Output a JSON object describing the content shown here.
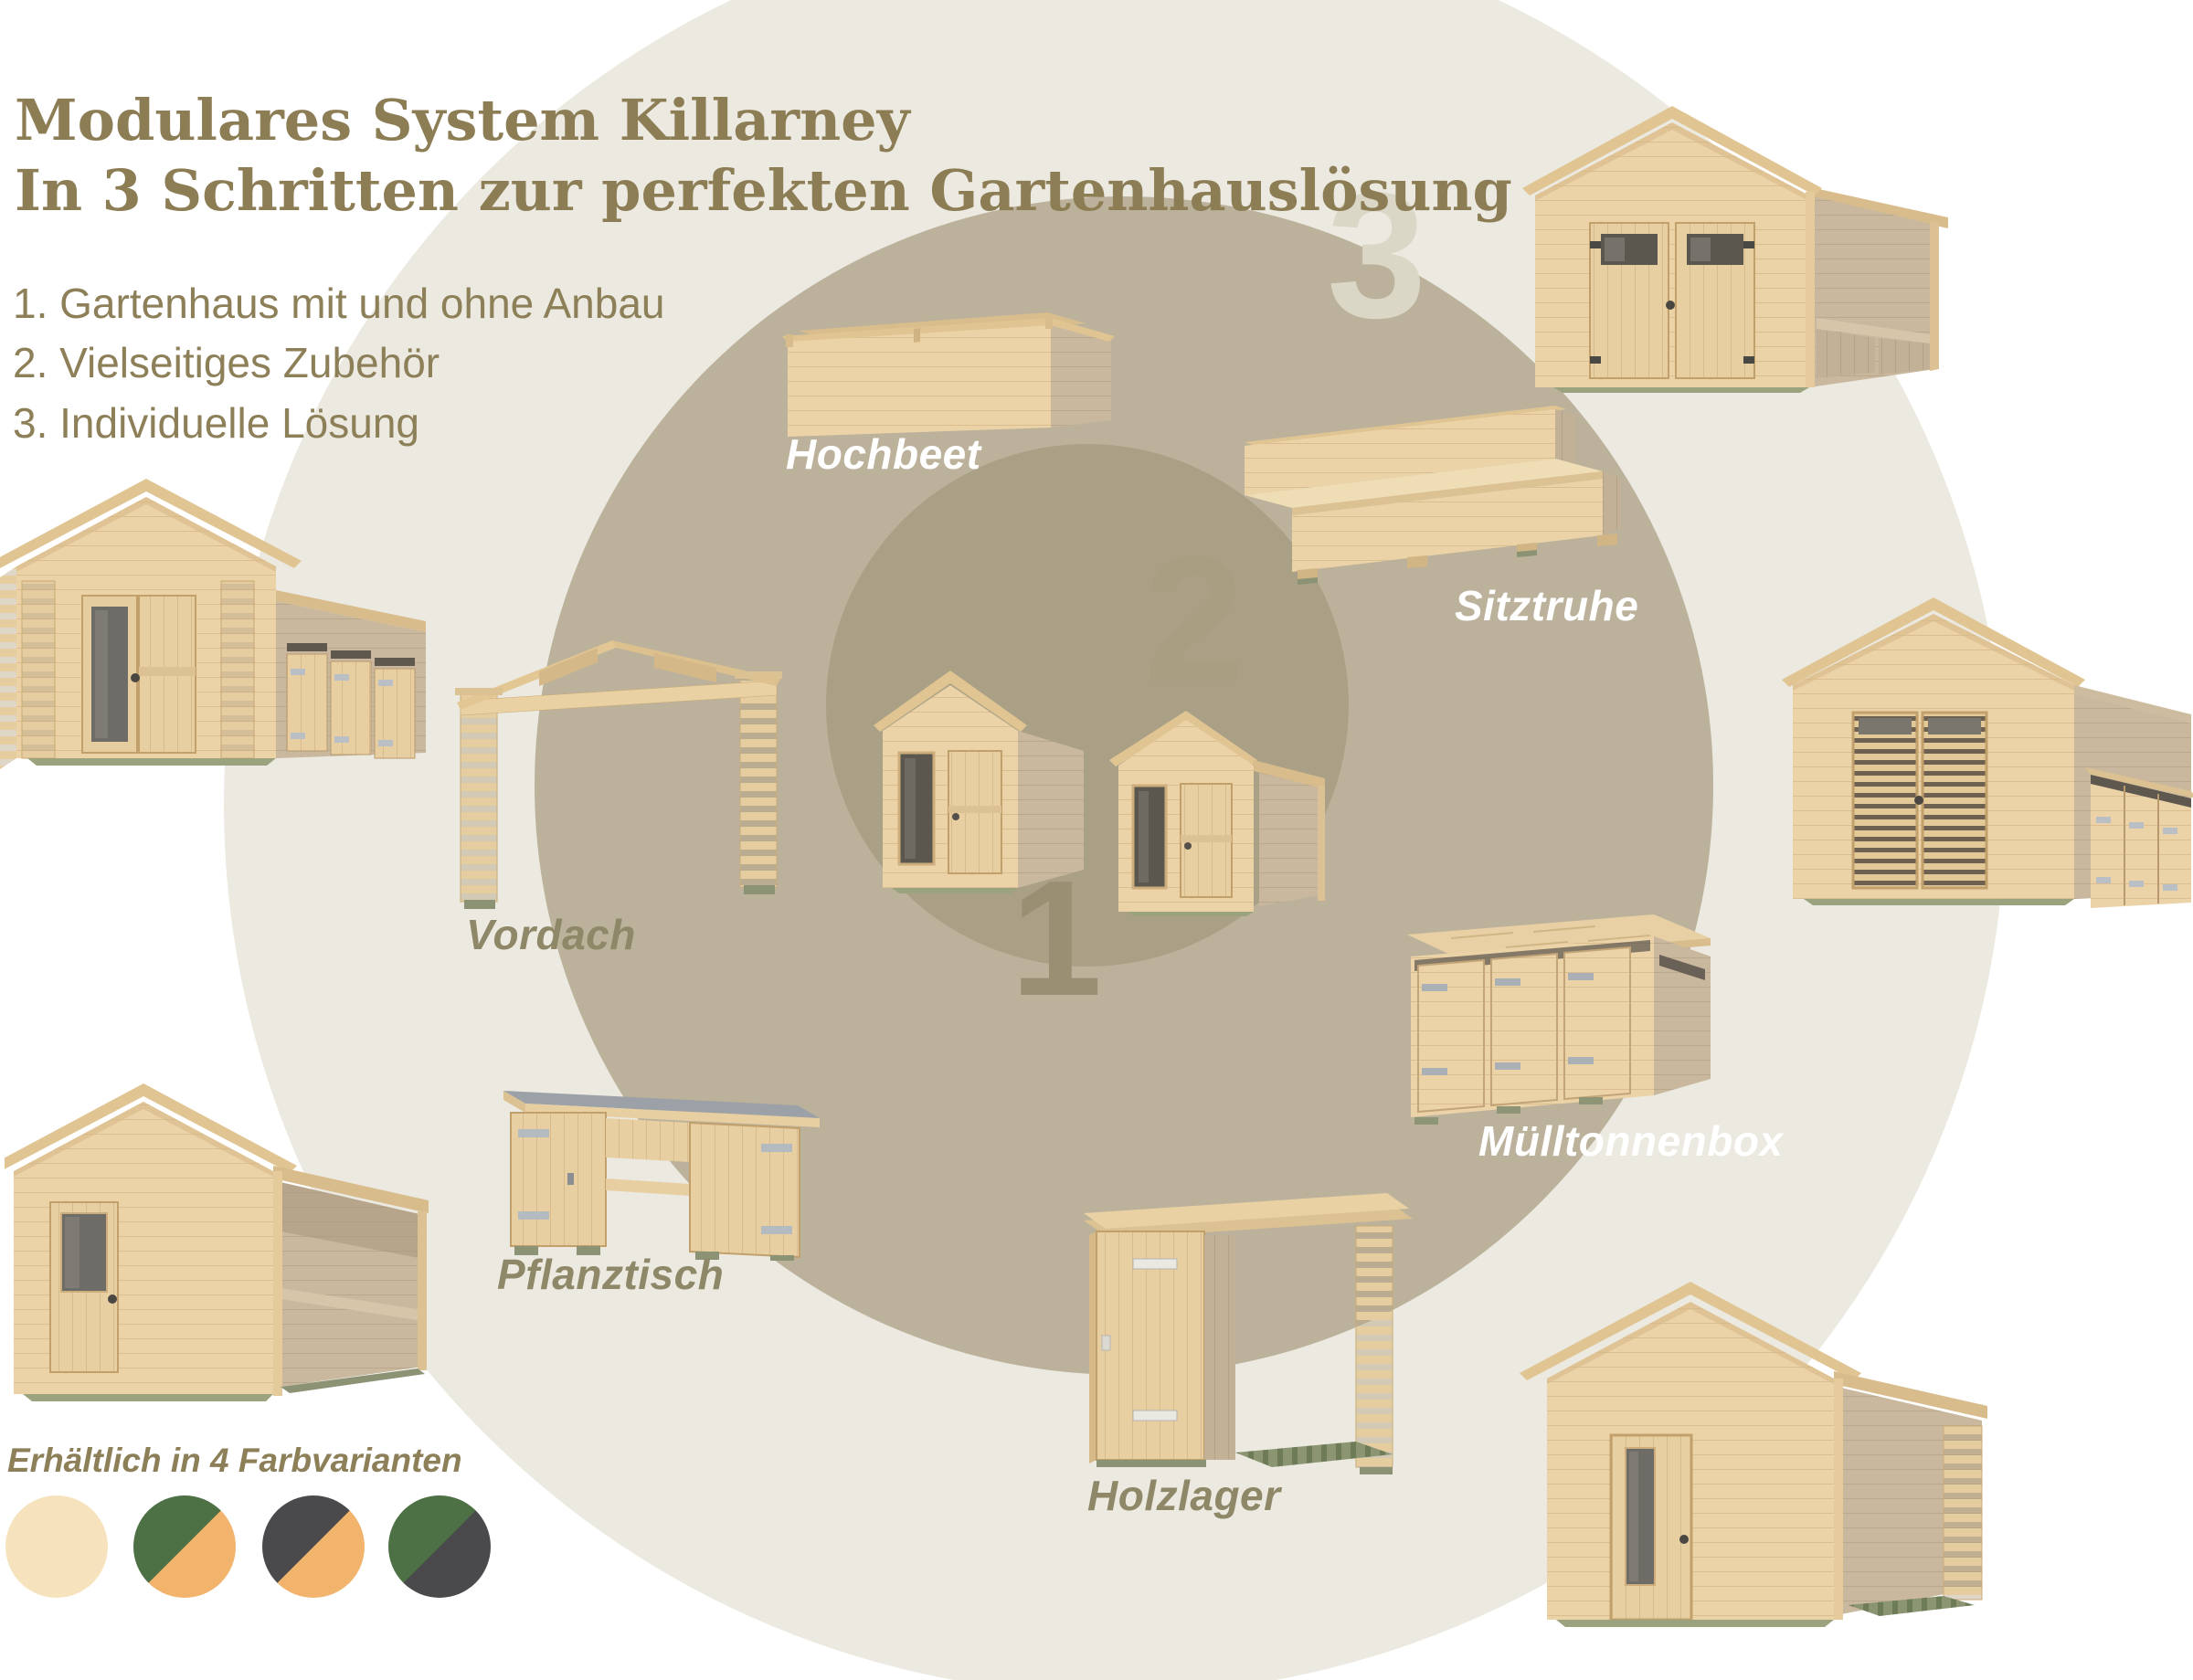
{
  "header": {
    "title_line1": "Modulares System Killarney",
    "title_line2": "In 3 Schritten zur perfekten Gartenhauslösung",
    "steps": [
      "1. Gartenhaus mit und ohne Anbau",
      "2. Vielseitiges Zubehör",
      "3. Individuelle Lösung"
    ]
  },
  "rings": {
    "numbers": {
      "step1": "1",
      "step2": "2",
      "step3": "3"
    }
  },
  "products": {
    "hochbeet": "Hochbeet",
    "sitztruhe": "Sitztruhe",
    "vordach": "Vordach",
    "muelltonnenbox": "Mülltonnenbox",
    "pflanztisch": "Pflanztisch",
    "holzlager": "Holzlager"
  },
  "color_variants": {
    "heading": "Erhältlich in 4 Farbvarianten",
    "swatches": [
      {
        "name": "natur",
        "colors": [
          "#f6e3bd"
        ]
      },
      {
        "name": "gruen-orange",
        "colors": [
          "#4d7045",
          "#f2b46c"
        ]
      },
      {
        "name": "anthrazit-orange",
        "colors": [
          "#4a4a4c",
          "#f2b46c"
        ]
      },
      {
        "name": "gruen-anthrazit",
        "colors": [
          "#4d7045",
          "#4a4a4c"
        ]
      }
    ]
  },
  "theme": {
    "title_color": "#8c7d55",
    "text_color": "#8d8059",
    "label_on_circle": "#ffffff",
    "label_on_light": "#8e8768",
    "outer_circle": "#ebe9e0",
    "middle_circle": "#bcb29b",
    "inner_circle": "#a9a086",
    "number3_color": "#dbd7c7",
    "number2_color": "#a89e81",
    "number1_color": "#998f73",
    "wood_light": "#ebd3a7",
    "wood_roof": "#e0c593",
    "wood_side": "#c9b89e",
    "base_green": "#8c9374"
  }
}
